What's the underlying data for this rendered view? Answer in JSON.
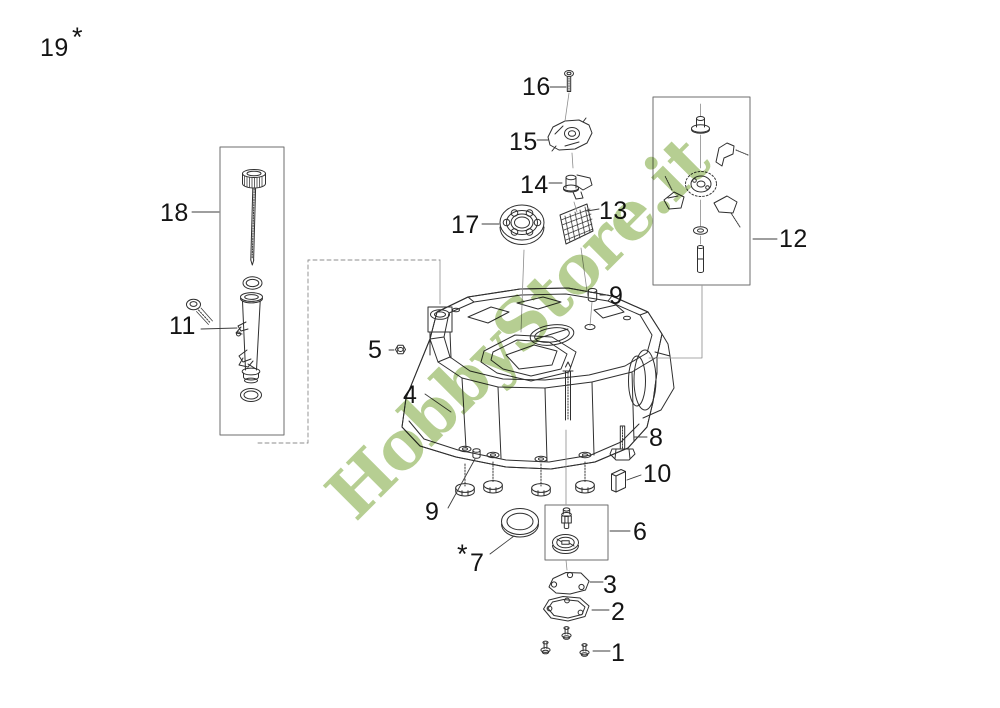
{
  "diagram": {
    "kind": "exploded-parts-diagram",
    "background": "#ffffff",
    "line_color": "#2f2f2f",
    "box_color": "#6e6e6e"
  },
  "watermark": {
    "text": "HobbyStore.it",
    "color": "#b2cc8c"
  },
  "symbols": {
    "asterisk": "*"
  },
  "callouts": {
    "n1": "1",
    "n2": "2",
    "n3": "3",
    "n4": "4",
    "n5": "5",
    "n6": "6",
    "n7": "7",
    "n8": "8",
    "n9": "9",
    "n10": "10",
    "n11": "11",
    "n12": "12",
    "n13": "13",
    "n14": "14",
    "n15": "15",
    "n16": "16",
    "n17": "17",
    "n18": "18",
    "n19": "19"
  }
}
